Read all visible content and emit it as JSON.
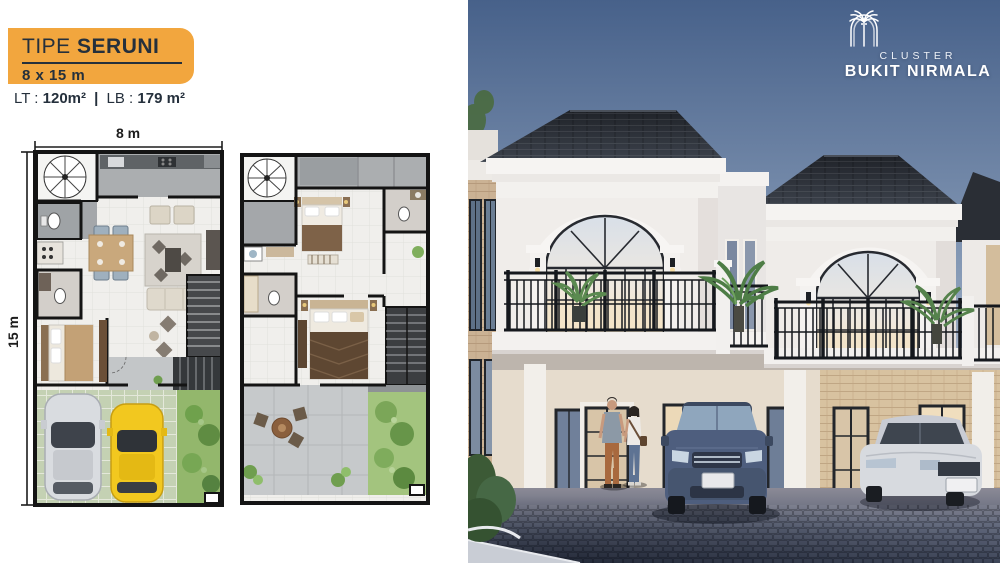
{
  "banner": {
    "type_label": "TIPE",
    "type_name": "SERUNI",
    "size": "8 x 15 m",
    "bg_color": "#F2A63E",
    "text_color": "#25303C"
  },
  "areas": {
    "lt_label": "LT :",
    "lt_value": "120m²",
    "separator": "|",
    "lb_label": "LB :",
    "lb_value": "179 m²"
  },
  "floorplan": {
    "width_label": "8 m",
    "height_label": "15 m"
  },
  "logo": {
    "icon": "palm-tree-arch-icon",
    "line1": "CLUSTER",
    "line2": "BUKIT NIRMALA"
  },
  "colors": {
    "accent_orange": "#F2A63E",
    "navy_text": "#25303C",
    "sky_top": "#4A648C",
    "sky_bottom": "#C9C9D2",
    "roof_dark": "#23262C",
    "facade_white": "#F0EDEA",
    "brick_tan": "#D8C2A0",
    "pavement": "#3A4356",
    "grass_green": "#93B76C",
    "suv_blue": "#4E5E7E",
    "sedan_silver": "#D7DADF",
    "car_yellow": "#F2C81F"
  }
}
